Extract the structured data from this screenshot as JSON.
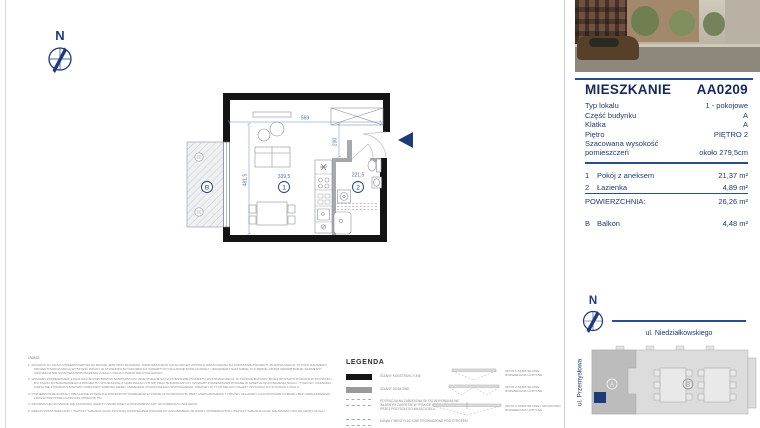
{
  "compass": {
    "north_label": "N"
  },
  "panel": {
    "title": "MIESZKANIE",
    "unit_code": "AA0209",
    "details": [
      {
        "label": "Typ lokalu",
        "value": "1 - pokojowe"
      },
      {
        "label": "Część budynku",
        "value": "A"
      },
      {
        "label": "Klatka",
        "value": "A"
      },
      {
        "label": "Piętro",
        "value": "PIĘTRO 2"
      },
      {
        "label": "Szacowana wysokość pomieszczeń",
        "value": "około 279,5cm"
      }
    ],
    "rooms": [
      {
        "no": "1",
        "name": "Pokój z aneksem",
        "area": "21,37 m²"
      },
      {
        "no": "2",
        "name": "Łazienka",
        "area": "4,89 m²"
      }
    ],
    "total": {
      "label": "POWIERZCHNIA:",
      "value": "26,26 m²"
    },
    "balcony": {
      "no": "B",
      "name": "Balkon",
      "area": "4,48 m²"
    },
    "compass_north": "N",
    "street_top": "ul. Niedziałkowskiego",
    "street_left": "ul. Przemysłowa",
    "site_blocks": {
      "a": "A",
      "b": "B"
    }
  },
  "plan": {
    "dim_top": "569",
    "dim_hall": "230",
    "dim_left": "481,5",
    "dim_room1": "339,5",
    "dim_room2": "221,5",
    "marker_room1": "1",
    "marker_room2": "2",
    "marker_balcony": "B"
  },
  "notes": {
    "title": "UWAGI:",
    "items": [
      "1. ARANŻACJA LOKALU PRZEDSTAWIONA NA RZUCIE JEST PRZYKŁADOWA. NINIEJSZA KARTA KATALOGOWA ZOSTAŁA OPRACOWANA NA PODSTAWIE PROJEKTU BUDOWLANEGO. W TOKU DALSZEGO PROJEKTOWANIA MOGĄ WYSTĄPIĆ ZMIANY W STOSUNKU DO INFORMACJI ZAWARTYCH NA KARCIE KATALOGOWEJ. URZĄDZENIA SANITARNE, KUCHENNE, DRZWI WEWNĘTRZNE I ELEMENTY ARANŻACJI NIE STANOWIĄ WYPOSAŻENIA LOKALU I MAJĄ CHARAKTER POGLĄDOWY.",
      "2. WYMIARY POMIESZCZEŃ, LOKALIZACJE PRZYBORÓW SANITARNYCH I INNE PODANE SĄ NA PODSTAWIE PROJEKTU WYKONAWCZEGO. W TRAKCIE BUDOWY MOGĄ WYSTĄPIĆ RÓŻNICE W STOSUNKU DO STANU WYBUDOWANEGO Z PROJEKTU, WYNIKAJĄCE Z ODBYWAJĄCYCH SIĘ PRAC BUDOWLANYCH. WYMIARY POMIESZCZEŃ PODANE W ŚWIETLE WYKOŃCZENIA ŚCIAN - TYNKÓW I OKŁADZIN. KARTA NIE POWINNA STANOWIĆ PODSTAWY DOBORU MEBLI, URZĄDZEŃ I POZOSTAŁEGO WYPOSAŻENIA. POMIARY W TYCH CELACH NALEŻY WYKONAĆ PO WYDANIU LOKALU.",
      "3. POWIERZCHNIE ZOSTAŁY OBLICZONE W ŚWIETLE PIONOWYCH PRZEGRÓD W STANIE WYKOŃCZONYM, PRZY UWZGLĘDNIENIU TYNKÓW I OKŁADZIN, NA PODSTAWIE POMIARU BEZ UWZGLĘDNIENIA LISTEW PRZYPODŁOGOWYCH, PROGÓW ITP.",
      "4. INFORMACJE NA KARCIE NIE STANOWIĄ OFERTY HANDLOWEJ W ROZUMIENIU ART. 66 KODEKSU CYWILNEGO.",
      "5. RZECZYWISTA WIELKOŚĆ I KSZTAŁT TARASU/LOGGII ZOSTANĄ OSTATECZNIE PODANE PO ZAKOŃCZENIU BUDOWY. POWIERZCHNIA I KSZTAŁT TARASU/LOGGII NIE MA WPŁYWU NA CENĘ LOKALU."
    ]
  },
  "legend": {
    "title": "LEGENDA",
    "walls": [
      {
        "label": "ŚCIANY KONSTRUKCYJNE"
      },
      {
        "label": "ŚCIANY DZIAŁOWE"
      },
      {
        "label": "POTENCJALNA ZABUDOWA GK DO WYKONANIA WE WŁASNYM ZAKRESIE W TRAKCIE PRAC ARANŻACYJNYCH PRZEZ PRZYSZŁEGO WŁAŚCICIELA"
      },
      {
        "label": "KANAŁY WENTYLACYJNE PROWADZONE POD STROPEM"
      }
    ],
    "windows": [
      {
        "label": "OKNO 1-SKRZYDŁOWE ROZWIERANO-UCHYLNE"
      },
      {
        "label": "OKNO 2-SKRZYDŁOWE ROZWIERANO-UCHYLNE"
      },
      {
        "label": "OKNO 3-SKRZYDŁOWE I ŚRODKOWO ROZWIERANO-UCHYLNE"
      }
    ]
  },
  "colors": {
    "navy_text": "#1e3a70",
    "rule_blue": "#2a4d8f",
    "dim_blue": "#5b7cc0",
    "marker_navy": "#1b3c77",
    "wall_black": "#141414",
    "partition_gray": "#a6a8ab"
  }
}
